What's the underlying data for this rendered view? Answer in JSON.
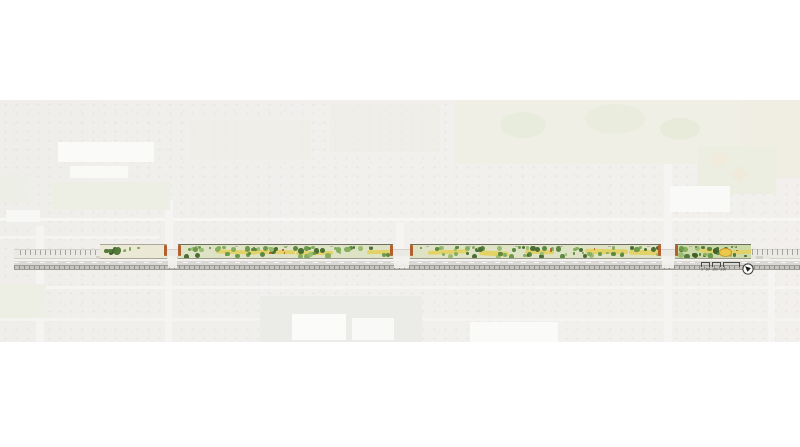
{
  "canvas": {
    "width": 800,
    "height": 447,
    "background": "#ffffff"
  },
  "aerial": {
    "x": 0,
    "y": 100,
    "width": 800,
    "height": 242,
    "base_color": "#ebeae6",
    "features": [
      {
        "name": "street-horizontal-upper",
        "x": 0,
        "y": 218,
        "w": 800,
        "h": 3,
        "c": "#f3f2ef"
      },
      {
        "name": "street-horizontal-mid-left",
        "x": 0,
        "y": 236,
        "w": 160,
        "h": 2.5,
        "c": "#f1f0ed"
      },
      {
        "name": "street-horizontal-lower-1",
        "x": 0,
        "y": 286,
        "w": 800,
        "h": 3,
        "c": "#f2f1ee"
      },
      {
        "name": "street-horizontal-lower-2",
        "x": 0,
        "y": 318,
        "w": 800,
        "h": 2.5,
        "c": "#f1f0ed",
        "op": 0.8
      },
      {
        "name": "street-vertical-1",
        "x": 36,
        "y": 226,
        "w": 8,
        "h": 116,
        "c": "#f1f0ed"
      },
      {
        "name": "street-vertical-2",
        "x": 165,
        "y": 200,
        "w": 8,
        "h": 56,
        "c": "#f1f0ed"
      },
      {
        "name": "street-vertical-3",
        "x": 396,
        "y": 222,
        "w": 8,
        "h": 34,
        "c": "#f1f0ed"
      },
      {
        "name": "street-vertical-4",
        "x": 664,
        "y": 150,
        "w": 8,
        "h": 106,
        "c": "#f1f0ed"
      },
      {
        "name": "street-vertical-5",
        "x": 664,
        "y": 268,
        "w": 8,
        "h": 74,
        "c": "#f1f0ed"
      },
      {
        "name": "street-vertical-6",
        "x": 768,
        "y": 268,
        "w": 7,
        "h": 74,
        "c": "#f1f0ed"
      },
      {
        "name": "street-vertical-7",
        "x": 165,
        "y": 268,
        "w": 7,
        "h": 74,
        "c": "#f1f0ed"
      },
      {
        "name": "golf-course",
        "x": 455,
        "y": 100,
        "w": 345,
        "h": 64,
        "c": "#e8e9da"
      },
      {
        "name": "golf-green-1",
        "x": 500,
        "y": 112,
        "w": 46,
        "h": 26,
        "c": "#dfe4cd",
        "br": "50%"
      },
      {
        "name": "golf-green-2",
        "x": 585,
        "y": 104,
        "w": 60,
        "h": 30,
        "c": "#e1e5cf",
        "br": "50%"
      },
      {
        "name": "golf-green-3",
        "x": 660,
        "y": 118,
        "w": 40,
        "h": 22,
        "c": "#dee3cb",
        "br": "50%"
      },
      {
        "name": "open-field-right",
        "x": 742,
        "y": 100,
        "w": 58,
        "h": 78,
        "c": "#eae6d7"
      },
      {
        "name": "park-right",
        "x": 698,
        "y": 146,
        "w": 78,
        "h": 48,
        "c": "#e3e7d5"
      },
      {
        "name": "ballfield-1",
        "x": 712,
        "y": 152,
        "w": 14,
        "h": 14,
        "c": "#eae3cc",
        "rot": 45
      },
      {
        "name": "ballfield-2",
        "x": 733,
        "y": 168,
        "w": 13,
        "h": 13,
        "c": "#e8e1ca",
        "rot": 45
      },
      {
        "name": "school-right-roof",
        "x": 670,
        "y": 186,
        "w": 60,
        "h": 26,
        "c": "#f7f7f4"
      },
      {
        "name": "school-left-roof-1",
        "x": 58,
        "y": 142,
        "w": 96,
        "h": 20,
        "c": "#f8f8f5"
      },
      {
        "name": "school-left-roof-2",
        "x": 70,
        "y": 166,
        "w": 58,
        "h": 12,
        "c": "#f6f6f3"
      },
      {
        "name": "school-left-field",
        "x": 52,
        "y": 182,
        "w": 118,
        "h": 28,
        "c": "#e6e9d9"
      },
      {
        "name": "parking-lot",
        "x": 260,
        "y": 296,
        "w": 162,
        "h": 46,
        "c": "#e3e2de",
        "pat": "rows"
      },
      {
        "name": "store-roof-1",
        "x": 292,
        "y": 314,
        "w": 54,
        "h": 26,
        "c": "#fafaf7"
      },
      {
        "name": "store-roof-2",
        "x": 352,
        "y": 318,
        "w": 42,
        "h": 22,
        "c": "#f7f7f4"
      },
      {
        "name": "store-roof-3",
        "x": 470,
        "y": 322,
        "w": 88,
        "h": 20,
        "c": "#f8f8f5"
      },
      {
        "name": "green-patch-left",
        "x": 0,
        "y": 284,
        "w": 46,
        "h": 34,
        "c": "#e5e8da"
      },
      {
        "name": "green-patch-left-2",
        "x": 0,
        "y": 176,
        "w": 30,
        "h": 26,
        "c": "#e6e8db"
      },
      {
        "name": "apartment-left-roof",
        "x": 6,
        "y": 210,
        "w": 34,
        "h": 12,
        "c": "#f4f4f1"
      },
      {
        "name": "tan-block-1",
        "x": 190,
        "y": 120,
        "w": 120,
        "h": 40,
        "c": "#e9e6dd",
        "op": 0.7
      },
      {
        "name": "tan-block-2",
        "x": 330,
        "y": 104,
        "w": 110,
        "h": 48,
        "c": "#e8e5dc",
        "op": 0.6
      }
    ]
  },
  "corridor": {
    "strip_top": 244,
    "strip_height": 12.5,
    "bands": [
      {
        "name": "street-edge-band",
        "x": 14,
        "y": 249,
        "w": 786,
        "h": 8,
        "c": "#eae9e4",
        "bd": "#d2d1cc"
      },
      {
        "name": "multiuse-path",
        "x": 96,
        "y": 256,
        "w": 674,
        "h": 2.5,
        "pat": "path"
      },
      {
        "name": "road-shoulder",
        "x": 14,
        "y": 258.5,
        "w": 786,
        "h": 2,
        "c": "#f3f2ef"
      },
      {
        "name": "roadway",
        "x": 14,
        "y": 260.5,
        "w": 786,
        "h": 4,
        "c": "#d9d8d4"
      },
      {
        "name": "lane-line",
        "x": 14,
        "y": 262,
        "w": 786,
        "h": 1,
        "pat": "dashline"
      },
      {
        "name": "railroad",
        "x": 14,
        "y": 264.5,
        "w": 786,
        "h": 3.5,
        "pat": "rail"
      }
    ],
    "hatches": [
      {
        "name": "curb-hatch-left",
        "x": 20,
        "y": 250,
        "w": 78,
        "h": 5
      },
      {
        "name": "curb-hatch-right",
        "x": 752,
        "y": 249,
        "w": 48,
        "h": 6
      }
    ],
    "segments": [
      {
        "name": "planting-segment-1",
        "x": 100,
        "w": 67,
        "style": "sparse"
      },
      {
        "name": "planting-segment-2",
        "x": 178,
        "w": 215,
        "style": "planted"
      },
      {
        "name": "planting-segment-3",
        "x": 410,
        "w": 251,
        "style": "planted"
      },
      {
        "name": "planting-segment-4",
        "x": 675,
        "w": 76,
        "style": "dense",
        "accent_x": 44
      }
    ],
    "intersections": [
      {
        "name": "intersection-1",
        "x": 167,
        "w": 11
      },
      {
        "name": "intersection-2",
        "x": 393,
        "w": 17
      },
      {
        "name": "intersection-3",
        "x": 661,
        "w": 14
      }
    ],
    "palette": {
      "tree_greens": [
        "#4a6e33",
        "#5d8840",
        "#6d9a49",
        "#85ae5f",
        "#9bbd72"
      ],
      "dark_greens": [
        "#3f5f2b",
        "#4a6e33",
        "#55793b"
      ],
      "yellow_band": "#e2d163",
      "rust_accent": "#b35f2e",
      "planted_bg": "#dfe3c6",
      "sparse_bg": "#ebe9d6",
      "dense_bg": "#ccd9a9",
      "accent_circle": "#ecc94b",
      "accent_circle_ring": "#c9972e",
      "furniture_gray": "#b4b3ad"
    }
  },
  "legend": {
    "scale_bar": {
      "labels": [
        "0'",
        "50'",
        "100'",
        "200'"
      ]
    },
    "north_arrow": {
      "icon": "compass-arrow-southeast",
      "ring_color": "#3a3a37"
    }
  }
}
